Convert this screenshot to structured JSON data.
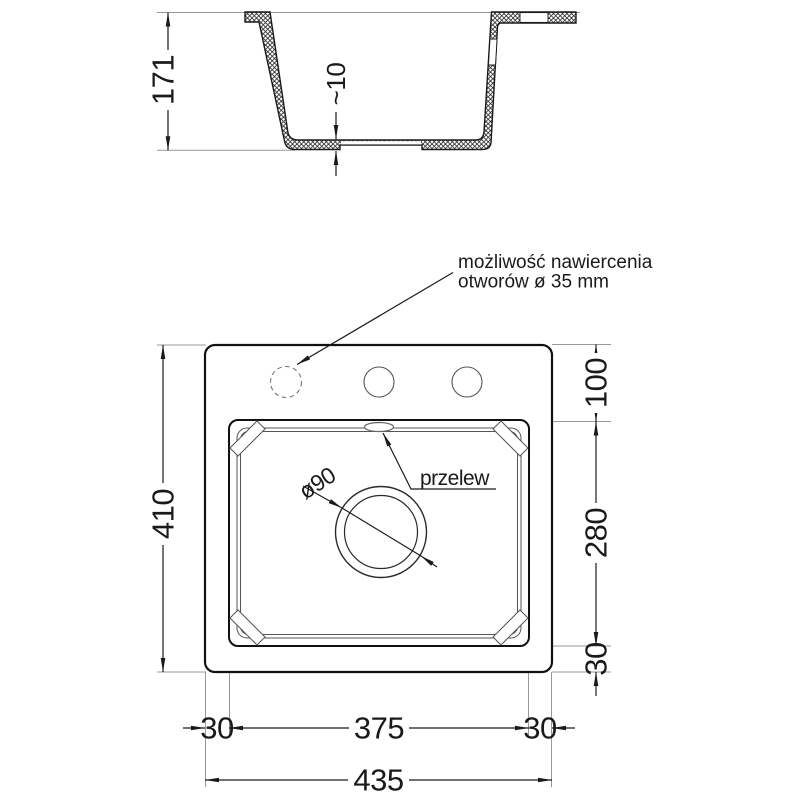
{
  "section": {
    "depth": "171",
    "floor_thickness": "~10"
  },
  "plan": {
    "total_depth": "410",
    "top_offset": "100",
    "bowl_depth": "280",
    "bottom_offset": "30",
    "margin_left": "30",
    "bowl_width": "375",
    "margin_right": "30",
    "total_width": "435",
    "drain_label": "ø90",
    "overflow_label": "przelew",
    "note_line1": "możliwość nawiercenia",
    "note_line2": "otworów ø 35 mm"
  },
  "colors": {
    "line_main": "#1a1a1a",
    "line_thin": "#555555",
    "line_ext": "#999999",
    "hatch": "#3a3a3a"
  }
}
